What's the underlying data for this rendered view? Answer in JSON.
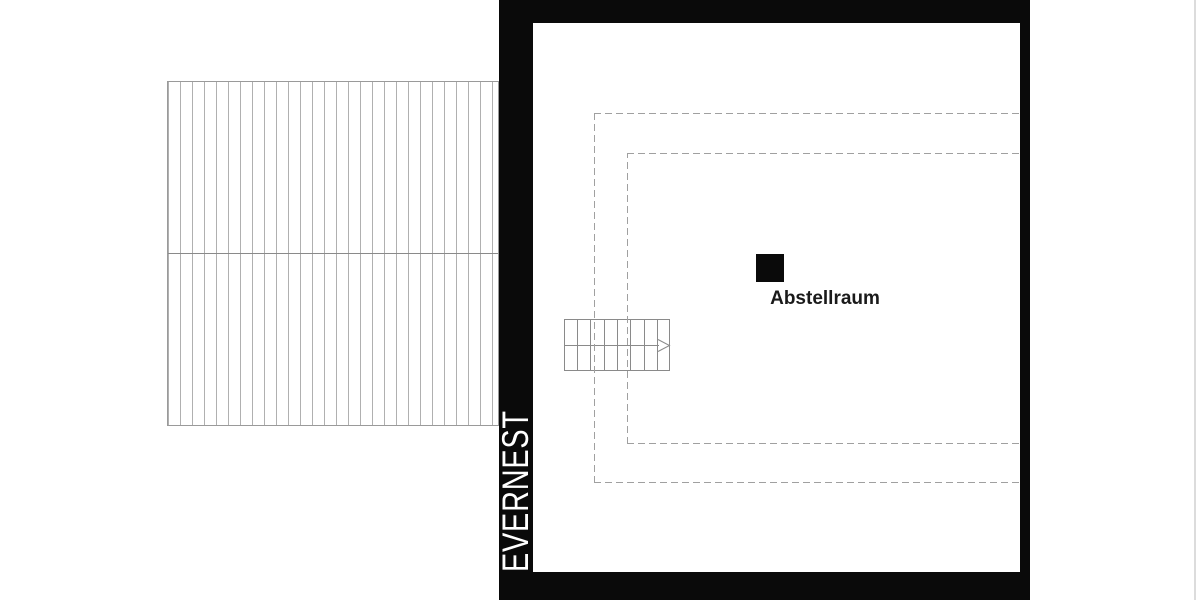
{
  "brand": {
    "name": "EVERNEST"
  },
  "plan": {
    "room_label": "Abstellraum",
    "stair_direction": "right",
    "colors": {
      "wall_black": "#0a0a0a",
      "plan_line_gray": "#8a8a8a",
      "dash_gray": "#a0a0a0",
      "hatch_gray": "#b0b0b0",
      "background": "#ffffff",
      "room_label_text": "#1a1a1a",
      "brand_text": "#ffffff",
      "page_edge_line": "#dcdcdc"
    }
  }
}
